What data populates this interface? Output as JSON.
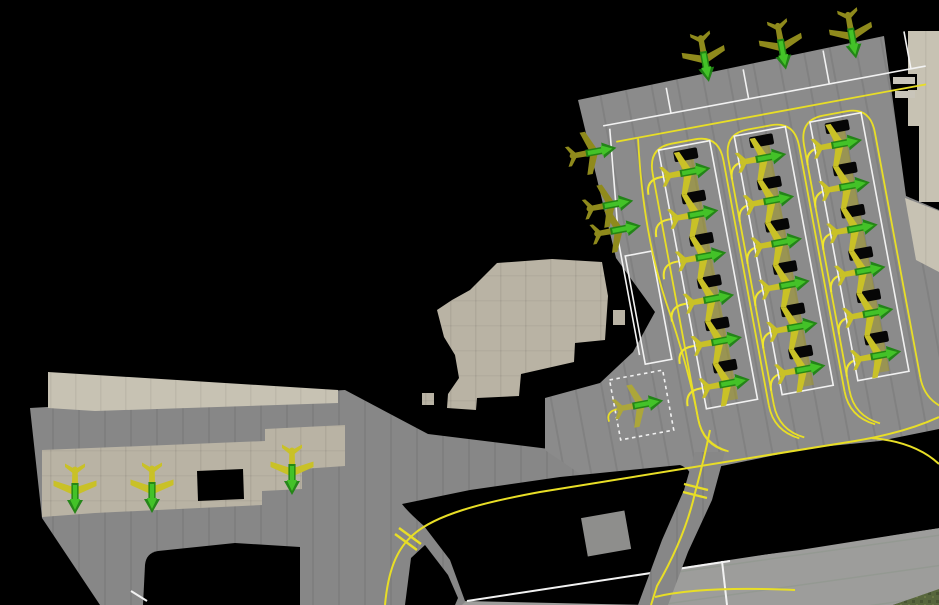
{
  "view": {
    "name": "airport-apron-top-down",
    "width": 939,
    "height": 605
  },
  "palette": {
    "background": "#000000",
    "apron_concrete": "#8b8b8b",
    "lower_concrete": "#878787",
    "taxiway_concrete": "#909090",
    "runway_band": "#9d9d9b",
    "old_apron_beige": "#b9b3a4",
    "beige_light": "#c7c2b3",
    "building_light": "#c9c5ba",
    "grass": "#57663c",
    "taxi_line_yellow": "#e8de26",
    "stand_stripe_yellow": "rgba(168,158,28,0.5)",
    "marking_white": "#f2f2f2",
    "equipment_pad_black": "#060606",
    "aircraft_yellow": "#c9c127",
    "aircraft_olive": "#8f8a1c",
    "aircraft_dull": "#aca63a",
    "arrow_green_dark": "#1d8413",
    "arrow_green_bright": "#43c228"
  },
  "apron": {
    "origin": {
      "x": 578,
      "y": 100
    },
    "rotation_deg": -10.5,
    "columns": [
      {
        "id": "row-A",
        "x": 70,
        "w": 52,
        "top": 64,
        "pitch": 43,
        "slots": 6,
        "lead_x": 52
      },
      {
        "id": "row-B",
        "x": 147,
        "w": 52,
        "top": 64,
        "pitch": 43,
        "slots": 6,
        "lead_x": 137
      },
      {
        "id": "row-C",
        "x": 224,
        "w": 52,
        "top": 64,
        "pitch": 43,
        "slots": 6,
        "lead_x": 214
      }
    ],
    "empty_stand": {
      "x": 18,
      "y": 162,
      "w": 27,
      "h": 110
    },
    "dotted_stand": {
      "x": -20,
      "y": 281,
      "w": 54,
      "h": 61
    }
  },
  "aircraft": [
    {
      "id": "A1",
      "frame": "apron",
      "x": 96,
      "y": 91,
      "heading_deg": 0,
      "state": "yellow"
    },
    {
      "id": "A2",
      "frame": "apron",
      "x": 96,
      "y": 134,
      "heading_deg": 0,
      "state": "yellow"
    },
    {
      "id": "A3",
      "frame": "apron",
      "x": 96,
      "y": 177,
      "heading_deg": 0,
      "state": "yellow"
    },
    {
      "id": "A4",
      "frame": "apron",
      "x": 96,
      "y": 220,
      "heading_deg": 0,
      "state": "yellow"
    },
    {
      "id": "A5",
      "frame": "apron",
      "x": 96,
      "y": 263,
      "heading_deg": 0,
      "state": "yellow"
    },
    {
      "id": "A6",
      "frame": "apron",
      "x": 96,
      "y": 306,
      "heading_deg": 0,
      "state": "yellow"
    },
    {
      "id": "B1",
      "frame": "apron",
      "x": 173,
      "y": 91,
      "heading_deg": 0,
      "state": "yellow"
    },
    {
      "id": "B2",
      "frame": "apron",
      "x": 173,
      "y": 134,
      "heading_deg": 0,
      "state": "yellow"
    },
    {
      "id": "B3",
      "frame": "apron",
      "x": 173,
      "y": 177,
      "heading_deg": 0,
      "state": "yellow"
    },
    {
      "id": "B4",
      "frame": "apron",
      "x": 173,
      "y": 220,
      "heading_deg": 0,
      "state": "yellow"
    },
    {
      "id": "B5",
      "frame": "apron",
      "x": 173,
      "y": 263,
      "heading_deg": 0,
      "state": "yellow"
    },
    {
      "id": "B6",
      "frame": "apron",
      "x": 173,
      "y": 306,
      "heading_deg": 0,
      "state": "yellow"
    },
    {
      "id": "C1",
      "frame": "apron",
      "x": 250,
      "y": 91,
      "heading_deg": 0,
      "state": "yellow"
    },
    {
      "id": "C2",
      "frame": "apron",
      "x": 250,
      "y": 134,
      "heading_deg": 0,
      "state": "yellow"
    },
    {
      "id": "C3",
      "frame": "apron",
      "x": 250,
      "y": 177,
      "heading_deg": 0,
      "state": "yellow"
    },
    {
      "id": "C4",
      "frame": "apron",
      "x": 250,
      "y": 220,
      "heading_deg": 0,
      "state": "yellow"
    },
    {
      "id": "C5",
      "frame": "apron",
      "x": 250,
      "y": 263,
      "heading_deg": 0,
      "state": "yellow"
    },
    {
      "id": "C6",
      "frame": "apron",
      "x": 250,
      "y": 306,
      "heading_deg": 0,
      "state": "yellow"
    },
    {
      "id": "T1",
      "frame": "apron",
      "x": 132,
      "y": -16,
      "heading_deg": 90,
      "state": "olive"
    },
    {
      "id": "T2",
      "frame": "apron",
      "x": 210,
      "y": -14,
      "heading_deg": 90,
      "state": "olive"
    },
    {
      "id": "T3",
      "frame": "apron",
      "x": 281,
      "y": -12,
      "heading_deg": 90,
      "state": "olive"
    },
    {
      "id": "E1",
      "frame": "apron",
      "x": 7,
      "y": 54,
      "heading_deg": 0,
      "state": "olive"
    },
    {
      "id": "E2",
      "frame": "apron",
      "x": 14,
      "y": 109,
      "heading_deg": 0,
      "state": "olive"
    },
    {
      "id": "E3",
      "frame": "apron",
      "x": 17,
      "y": 135,
      "heading_deg": 0,
      "state": "olive"
    },
    {
      "id": "D1",
      "frame": "apron",
      "x": 7,
      "y": 311,
      "heading_deg": 0,
      "state": "dull"
    },
    {
      "id": "L1",
      "frame": "page",
      "x": 75,
      "y": 492,
      "heading_deg": 90,
      "state": "yellow"
    },
    {
      "id": "L2",
      "frame": "page",
      "x": 152,
      "y": 491,
      "heading_deg": 90,
      "state": "yellow"
    },
    {
      "id": "L3",
      "frame": "page",
      "x": 292,
      "y": 473,
      "heading_deg": 90,
      "state": "yellow"
    }
  ],
  "counts": {
    "aircraft_total": 28,
    "stand_rows": 3,
    "stands_per_row": 6
  }
}
